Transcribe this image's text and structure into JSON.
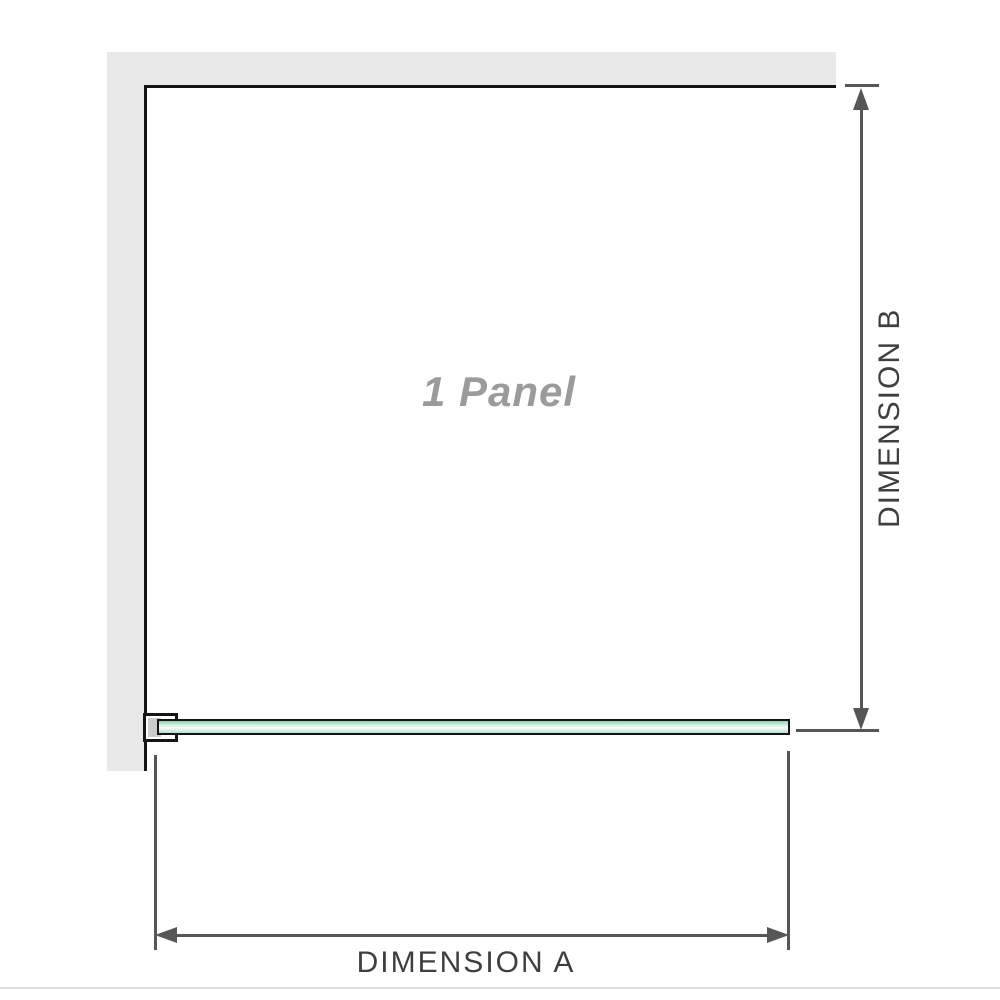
{
  "diagram": {
    "panel_label": "1 Panel",
    "dimension_a_label": "DIMENSION A",
    "dimension_b_label": "DIMENSION B"
  },
  "colors": {
    "wall": "#e9e9e9",
    "outline": "#151515",
    "dimension": "#565656",
    "label_text": "#3f3f3f",
    "panel_text": "#9b9b9b",
    "bracket_fill": "#cccccc",
    "baseline_rule": "#dcdcdc",
    "glass_dark": "#8fd0ae",
    "glass_mid": "#e3f4ea",
    "glass_hi": "#f7fcf9",
    "glass_low": "#b9e2cc"
  }
}
